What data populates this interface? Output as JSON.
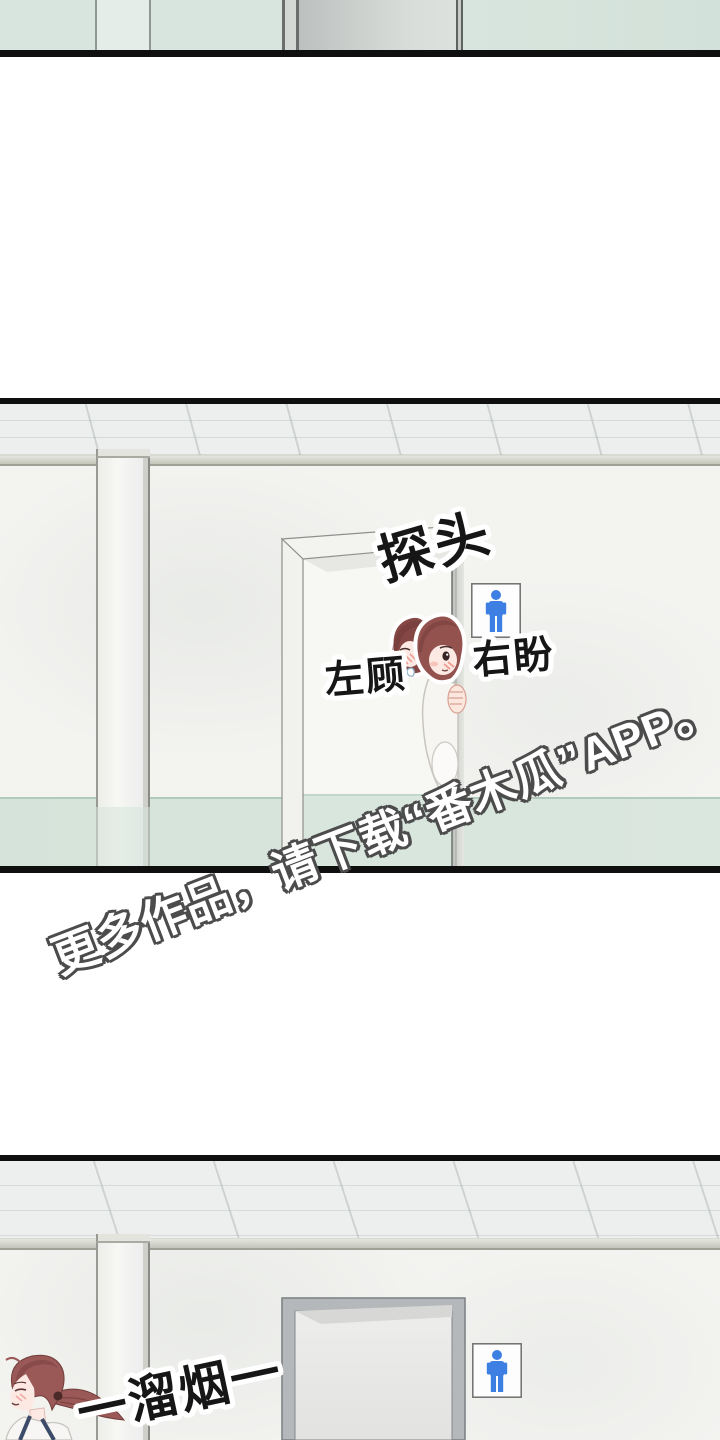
{
  "comic": {
    "panel_middle": {
      "sfx_peek": "探头",
      "label_look_left": "左顾",
      "label_look_right": "右盼",
      "sign": "mens-restroom"
    },
    "panel_bottom": {
      "sfx_sneak_away": "一溜烟一",
      "sign": "mens-restroom"
    },
    "watermark": "更多作品，请下载“番木瓜”APP。",
    "colors": {
      "restroom_sign_blue": "#3d7fe2",
      "wainscot_mint": "#d7e5dd",
      "hair_auburn": "#94524f",
      "panel_border_black": "#0f0f0f"
    }
  }
}
